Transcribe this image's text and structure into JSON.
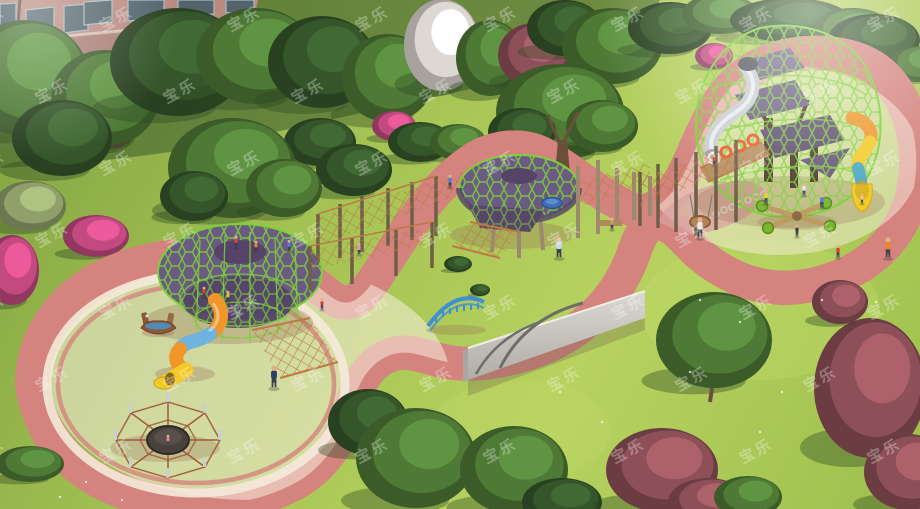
{
  "scene": {
    "description": "photorealistic 3D rendering of an outdoor children's playground in a park, aerial view",
    "watermark": {
      "text": "宝乐",
      "color": "#ffffff",
      "opacity": 0.3,
      "rotation_deg": -28,
      "font_size": 15,
      "rows": 7,
      "cols": 8,
      "spacing_x": 128,
      "spacing_y": 72,
      "offset_x": -30,
      "offset_y": 8,
      "row_stagger": 64
    },
    "palette": {
      "lawn": "#a8c452",
      "lawn_light": "#bcd765",
      "lawn_dark": "#7f9f41",
      "tree_shadow": "#3e5c2d",
      "building_wall": "#b98a80",
      "building_wall_dark": "#a87e75",
      "building_trim": "#d9c9be",
      "building_window": "#53646d",
      "window_frame": "#a8bcc0",
      "sand": "#f1e3d2",
      "sand_light": "#f8eede",
      "sand_shadow": "#d9c3ab",
      "path_pink": "#e9aca6",
      "path_dark": "#d4837e",
      "path_red": "#b35c52",
      "path_cream": "#f4ead9",
      "net_green": "#7cd138",
      "structure_purple": "#6b5a82",
      "structure_purple_dark": "#554468",
      "rope": "#bd7a44",
      "wood": "#9a8a72",
      "wood_dark": "#6e5e48",
      "trunk": "#6b4f3a",
      "slide_yellow": "#f4ca28",
      "slide_orange": "#f0962a",
      "slide_blue": "#6fb3e0",
      "slide_teal": "#4aa8c0",
      "metal": "#c9ced2",
      "metal_light": "#eef1f3",
      "wall_gray": "#cbc9c2",
      "wall_gray_dark": "#a8a69e",
      "arch_blue": "#3f8fd4",
      "trampoline": "#4a413c",
      "skin": "#e2b08a",
      "tree_green": "#4e7a36",
      "tree_dark": "#35562a",
      "tree_plum": "#8e5058",
      "tree_pink": "#c24a80",
      "tree_blossom": "#ded8d2",
      "tree_sage": "#8fa06a"
    },
    "equipment": [
      {
        "name": "tree-net-climber-left"
      },
      {
        "name": "spiral-tube-slide"
      },
      {
        "name": "boat-rocker"
      },
      {
        "name": "climbing-rope-net"
      },
      {
        "name": "spider-web-trampoline"
      },
      {
        "name": "rope-bridge-course"
      },
      {
        "name": "treehouse-net-platform"
      },
      {
        "name": "ground-spinner-disc"
      },
      {
        "name": "arch-ladder-climber"
      },
      {
        "name": "concrete-climbing-wall"
      },
      {
        "name": "net-dome-tower"
      },
      {
        "name": "stainless-steel-slide"
      },
      {
        "name": "tube-slide-right"
      },
      {
        "name": "ring-climber-bridge"
      },
      {
        "name": "basket-swing"
      },
      {
        "name": "four-seat-seesaw"
      }
    ],
    "trees_background": [
      {
        "t": "tree_green",
        "x": 25,
        "y": 78,
        "rx": 64,
        "ry": 58
      },
      {
        "t": "tree_plum",
        "x": 112,
        "y": 102,
        "rx": 34,
        "ry": 46
      },
      {
        "t": "tree_green",
        "x": 105,
        "y": 98,
        "rx": 54,
        "ry": 48
      },
      {
        "t": "tree_dark",
        "x": 178,
        "y": 62,
        "rx": 68,
        "ry": 54
      },
      {
        "t": "tree_green",
        "x": 256,
        "y": 56,
        "rx": 60,
        "ry": 48
      },
      {
        "t": "tree_dark",
        "x": 322,
        "y": 62,
        "rx": 54,
        "ry": 46
      },
      {
        "t": "tree_green",
        "x": 388,
        "y": 78,
        "rx": 46,
        "ry": 44
      },
      {
        "t": "tree_blossom",
        "x": 442,
        "y": 45,
        "rx": 38,
        "ry": 46
      },
      {
        "t": "tree_green",
        "x": 490,
        "y": 58,
        "rx": 34,
        "ry": 38
      },
      {
        "t": "tree_plum",
        "x": 534,
        "y": 55,
        "rx": 36,
        "ry": 32
      },
      {
        "t": "tree_dark",
        "x": 565,
        "y": 28,
        "rx": 38,
        "ry": 28
      },
      {
        "t": "tree_green",
        "x": 612,
        "y": 46,
        "rx": 50,
        "ry": 38
      },
      {
        "t": "tree_dark",
        "x": 670,
        "y": 28,
        "rx": 42,
        "ry": 26
      },
      {
        "t": "tree_green",
        "x": 720,
        "y": 14,
        "rx": 38,
        "ry": 20
      },
      {
        "t": "tree_dark",
        "x": 790,
        "y": 20,
        "rx": 60,
        "ry": 22
      },
      {
        "t": "tree_green",
        "x": 852,
        "y": 30,
        "rx": 40,
        "ry": 22
      },
      {
        "t": "tree_dark",
        "x": 874,
        "y": 40,
        "rx": 46,
        "ry": 26
      },
      {
        "t": "tree_green",
        "x": 916,
        "y": 64,
        "rx": 26,
        "ry": 18
      },
      {
        "t": "tree_pink",
        "x": 714,
        "y": 56,
        "rx": 19,
        "ry": 13
      },
      {
        "t": "tree_pink",
        "x": 394,
        "y": 126,
        "rx": 22,
        "ry": 15
      },
      {
        "t": "tree_dark",
        "x": 320,
        "y": 142,
        "rx": 36,
        "ry": 24
      },
      {
        "t": "tree_dark",
        "x": 354,
        "y": 170,
        "rx": 38,
        "ry": 26
      },
      {
        "t": "tree_dark",
        "x": 420,
        "y": 142,
        "rx": 32,
        "ry": 20
      },
      {
        "t": "tree_green",
        "x": 458,
        "y": 142,
        "rx": 28,
        "ry": 18
      },
      {
        "t": "tree_dark",
        "x": 62,
        "y": 138,
        "rx": 50,
        "ry": 38
      },
      {
        "t": "tree_sage",
        "x": 30,
        "y": 206,
        "rx": 36,
        "ry": 25
      },
      {
        "t": "tree_pink",
        "x": 96,
        "y": 236,
        "rx": 33,
        "ry": 21
      },
      {
        "t": "tree_pink",
        "x": 12,
        "y": 270,
        "rx": 27,
        "ry": 35
      },
      {
        "t": "tree_green",
        "x": 232,
        "y": 168,
        "rx": 64,
        "ry": 50
      },
      {
        "t": "tree_dark",
        "x": 194,
        "y": 196,
        "rx": 34,
        "ry": 25
      },
      {
        "t": "tree_green",
        "x": 284,
        "y": 188,
        "rx": 38,
        "ry": 29
      },
      {
        "t": "tree_green",
        "x": 560,
        "y": 112,
        "rx": 64,
        "ry": 48
      },
      {
        "t": "tree_dark",
        "x": 522,
        "y": 132,
        "rx": 34,
        "ry": 24
      },
      {
        "t": "tree_green",
        "x": 602,
        "y": 126,
        "rx": 36,
        "ry": 26
      }
    ],
    "trees_foreground": [
      {
        "t": "tree_dark",
        "x": 368,
        "y": 422,
        "rx": 40,
        "ry": 33
      },
      {
        "t": "tree_green",
        "x": 416,
        "y": 458,
        "rx": 60,
        "ry": 50
      },
      {
        "t": "tree_green",
        "x": 514,
        "y": 470,
        "rx": 54,
        "ry": 44
      },
      {
        "t": "tree_dark",
        "x": 562,
        "y": 502,
        "rx": 40,
        "ry": 24
      },
      {
        "t": "tree_plum",
        "x": 662,
        "y": 470,
        "rx": 56,
        "ry": 42
      },
      {
        "t": "tree_plum",
        "x": 708,
        "y": 502,
        "rx": 40,
        "ry": 24
      },
      {
        "t": "tree_green",
        "x": 748,
        "y": 497,
        "rx": 34,
        "ry": 21
      },
      {
        "t": "tree_green",
        "x": 714,
        "y": 340,
        "rx": 58,
        "ry": 48
      },
      {
        "t": "tree_plum",
        "x": 870,
        "y": 388,
        "rx": 56,
        "ry": 70
      },
      {
        "t": "tree_plum",
        "x": 908,
        "y": 472,
        "rx": 44,
        "ry": 38
      },
      {
        "t": "tree_plum",
        "x": 840,
        "y": 302,
        "rx": 28,
        "ry": 22
      },
      {
        "t": "tree_green",
        "x": 30,
        "y": 464,
        "rx": 34,
        "ry": 18
      },
      {
        "t": "tree_dark",
        "x": 458,
        "y": 264,
        "rx": 14,
        "ry": 8
      },
      {
        "t": "tree_dark",
        "x": 480,
        "y": 290,
        "rx": 10,
        "ry": 6
      }
    ],
    "people": [
      {
        "x": 236,
        "y": 248,
        "c": "#d6432f",
        "h": 13
      },
      {
        "x": 256,
        "y": 252,
        "c": "#e8862e",
        "h": 12
      },
      {
        "x": 204,
        "y": 298,
        "c": "#d6432f",
        "h": 12
      },
      {
        "x": 228,
        "y": 302,
        "c": "#e8c12e",
        "h": 12
      },
      {
        "x": 289,
        "y": 252,
        "c": "#4a7fd0",
        "h": 13
      },
      {
        "x": 359,
        "y": 255,
        "c": "#e891b4",
        "h": 13
      },
      {
        "x": 450,
        "y": 188,
        "c": "#4a7fd0",
        "h": 14
      },
      {
        "x": 274,
        "y": 388,
        "c": "#2e3f66",
        "h": 24
      },
      {
        "x": 322,
        "y": 310,
        "c": "#cc3b33",
        "h": 12
      },
      {
        "x": 168,
        "y": 446,
        "c": "#e87fa0",
        "h": 12
      },
      {
        "x": 559,
        "y": 258,
        "c": "#c8d8e8",
        "h": 23
      },
      {
        "x": 612,
        "y": 230,
        "c": "#c89a62",
        "h": 13
      },
      {
        "x": 714,
        "y": 166,
        "c": "#d6432f",
        "h": 12
      },
      {
        "x": 700,
        "y": 238,
        "c": "#e8e6e0",
        "h": 22
      },
      {
        "x": 766,
        "y": 204,
        "c": "#e8d23a",
        "h": 15
      },
      {
        "x": 797,
        "y": 237,
        "c": "#3a4050",
        "h": 13
      },
      {
        "x": 822,
        "y": 208,
        "c": "#4a7fd0",
        "h": 15
      },
      {
        "x": 804,
        "y": 196,
        "c": "#e8e6e0",
        "h": 14
      },
      {
        "x": 838,
        "y": 258,
        "c": "#d6432f",
        "h": 14
      },
      {
        "x": 888,
        "y": 258,
        "c": "#e8862e",
        "h": 22
      },
      {
        "x": 862,
        "y": 204,
        "c": "#e8c9a0",
        "h": 11
      }
    ]
  }
}
